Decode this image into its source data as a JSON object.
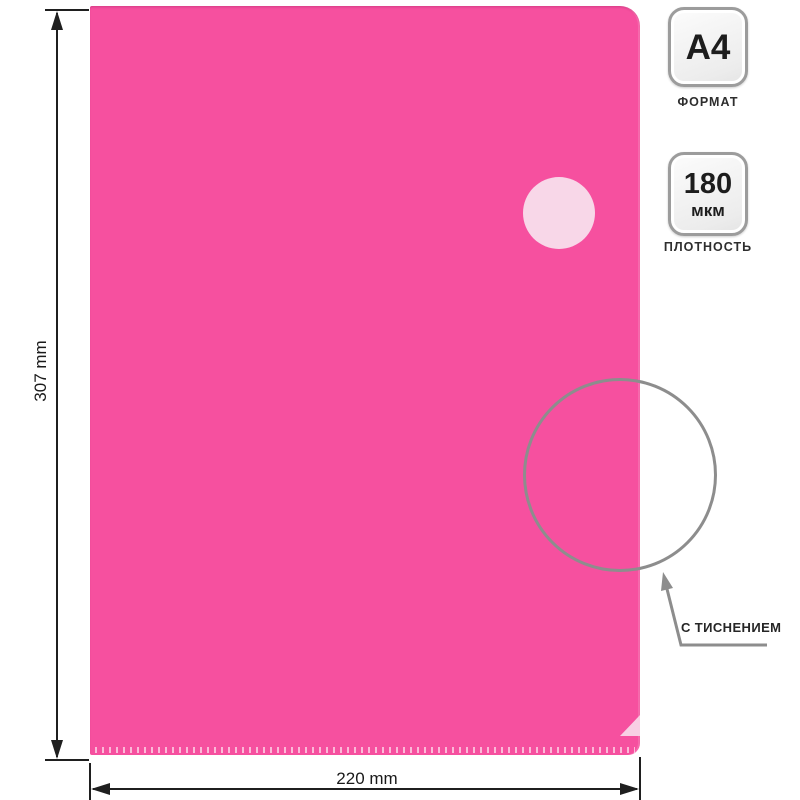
{
  "dimensions": {
    "height_label": "307 mm",
    "width_label": "220 mm"
  },
  "badges": {
    "format": {
      "value": "A4",
      "label": "ФОРМАТ"
    },
    "density": {
      "value": "180",
      "unit": "мкм",
      "label": "ПЛОТНОСТЬ"
    }
  },
  "callout": {
    "label": "С ТИСНЕНИЕМ"
  },
  "colors": {
    "folder_pink": "#f6509f",
    "cutout_pale_pink": "#f8d7e8",
    "detail_ring_gray": "#8d8d8d",
    "dimension_ink": "#1f1f1f",
    "badge_border_gray": "#9c9c9c",
    "badge_fill": "#ececec",
    "text_dark": "#1d1d1d"
  }
}
